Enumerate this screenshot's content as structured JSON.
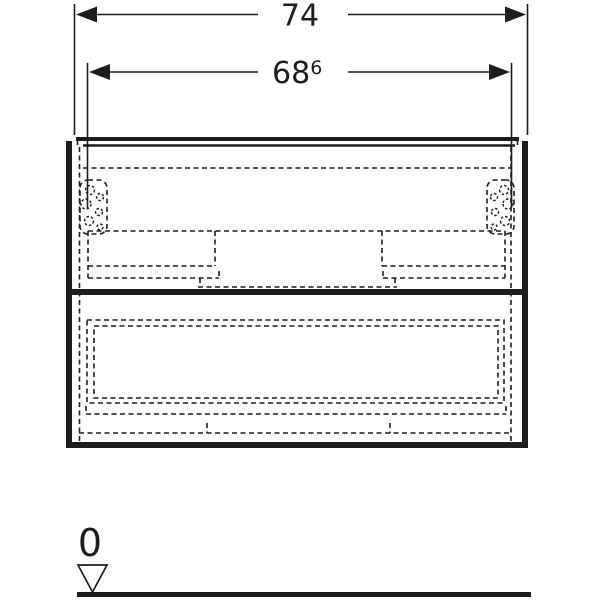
{
  "diagram": {
    "kind": "technical elevation drawing of a two-drawer vanity cabinet",
    "line_color": "#1d1d1b",
    "background_color": "#ffffff",
    "dimensions": [
      {
        "name": "overall-width",
        "label": "74"
      },
      {
        "name": "carcass-width",
        "label": "68",
        "superscript": "6"
      }
    ],
    "datum": {
      "label": "0",
      "icon": "ground-level-triangle-icon"
    }
  }
}
